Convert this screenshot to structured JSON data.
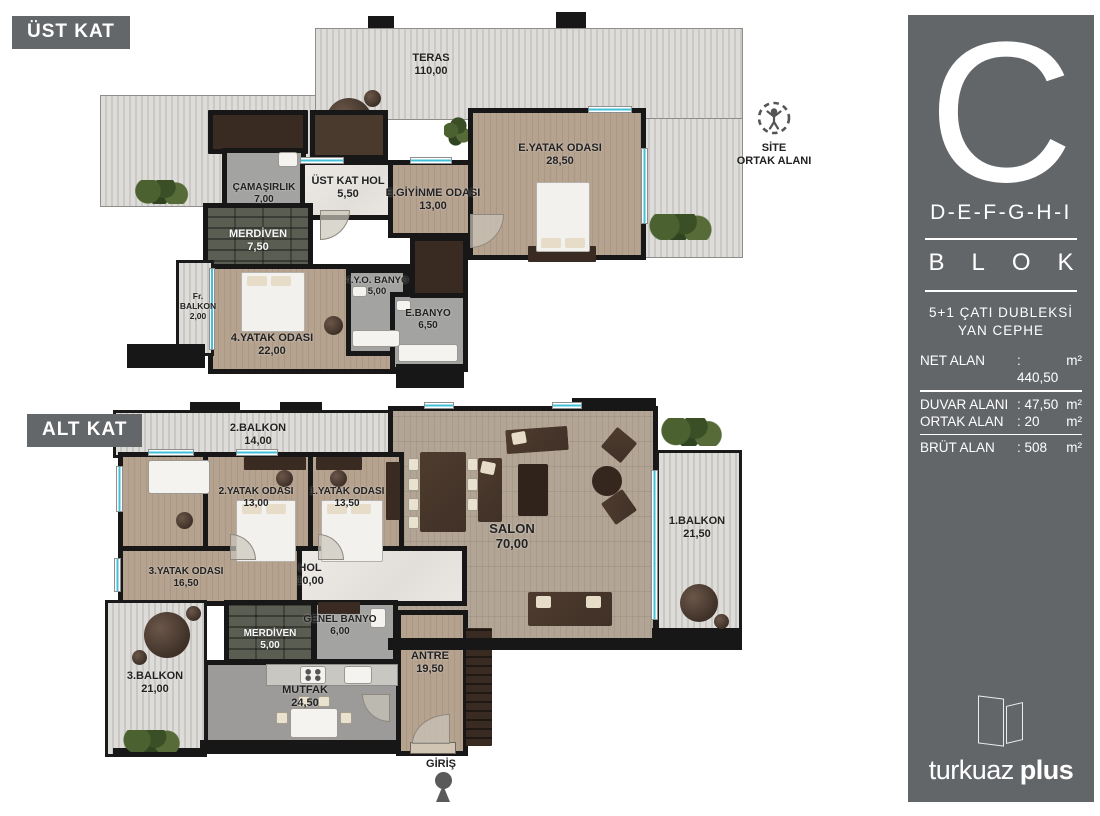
{
  "upper_floor": {
    "badge": "ÜST KAT",
    "rooms": [
      {
        "name": "TERAS",
        "area": "110,00"
      },
      {
        "name": "ÇAMAŞIRLIK",
        "area": "7,00"
      },
      {
        "name": "ÜST KAT HOL",
        "area": "5,50"
      },
      {
        "name": "E.GİYİNME ODASI",
        "area": "13,00"
      },
      {
        "name": "E.YATAK ODASI",
        "area": "28,50"
      },
      {
        "name": "MERDİVEN",
        "area": "7,50"
      },
      {
        "name": "Fr. BALKON",
        "area": "2,00"
      },
      {
        "name": "4.YATAK ODASI",
        "area": "22,00"
      },
      {
        "name": "4.Y.O. BANYO",
        "area": "5,00"
      },
      {
        "name": "E.BANYO",
        "area": "6,50"
      }
    ],
    "site_common": {
      "line1": "SİTE",
      "line2": "ORTAK ALANI"
    }
  },
  "lower_floor": {
    "badge": "ALT KAT",
    "rooms": [
      {
        "name": "2.BALKON",
        "area": "14,00"
      },
      {
        "name": "2.YATAK ODASI",
        "area": "13,00"
      },
      {
        "name": "1.YATAK ODASI",
        "area": "13,50"
      },
      {
        "name": "SALON",
        "area": "70,00"
      },
      {
        "name": "1.BALKON",
        "area": "21,50"
      },
      {
        "name": "3.YATAK ODASI",
        "area": "16,50"
      },
      {
        "name": "HOL",
        "area": "10,00"
      },
      {
        "name": "MERDİVEN",
        "area": "5,00"
      },
      {
        "name": "GENEL BANYO",
        "area": "6,00"
      },
      {
        "name": "ANTRE",
        "area": "19,50"
      },
      {
        "name": "3.BALKON",
        "area": "21,00"
      },
      {
        "name": "MUTFAK",
        "area": "24,50"
      }
    ],
    "entrance": {
      "label": "GİRİŞ"
    }
  },
  "sidebar": {
    "block_letter": "C",
    "block_range": "D-E-F-G-H-I",
    "block_word": "BLOK",
    "unit_type_line1": "5+1 ÇATI DUBLEKSİ",
    "unit_type_line2": "YAN CEPHE",
    "areas": [
      {
        "label": "NET ALAN",
        "value": ": 440,50",
        "unit": "m²"
      },
      {
        "label": "DUVAR ALANI",
        "value": ": 47,50",
        "unit": "m²"
      },
      {
        "label": "ORTAK ALAN",
        "value": ": 20",
        "unit": "m²"
      },
      {
        "label": "BRÜT ALAN",
        "value": ": 508",
        "unit": "m²"
      }
    ],
    "logo": {
      "word1": "turkuaz",
      "word2": "plus"
    }
  },
  "colors": {
    "accent_window": "#41c0d8",
    "sidebar_bg": "#636669",
    "wall": "#171717"
  }
}
